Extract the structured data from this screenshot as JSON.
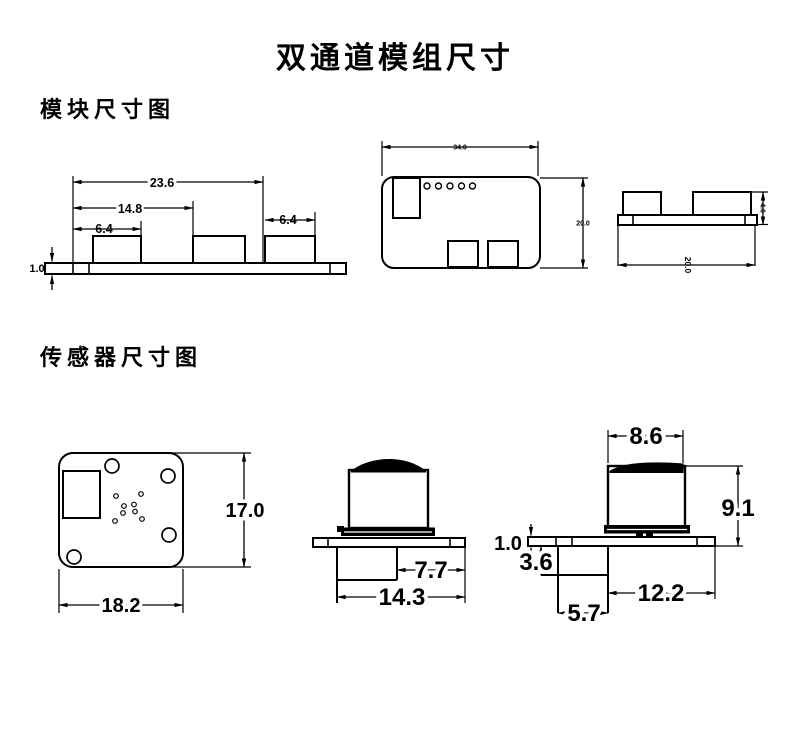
{
  "title": "双通道模组尺寸",
  "module_section": {
    "heading": "模块尺寸图",
    "side_view": {
      "overall_width": "23.6",
      "mid_width": "14.8",
      "left_box_width": "6.4",
      "right_box_width": "6.4",
      "plate_thickness": "1.0"
    },
    "top_view": {
      "board_width": "34.0",
      "board_depth": "20.0"
    },
    "end_view": {
      "box_height": "4.6",
      "board_depth": "20.0"
    }
  },
  "sensor_section": {
    "heading": "传感器尺寸图",
    "top_view": {
      "board_height": "17.0",
      "board_width": "18.2"
    },
    "front_view": {
      "inner_width": "7.7",
      "outer_width": "14.3"
    },
    "side_view": {
      "cap_width": "8.6",
      "total_height": "9.1",
      "plate_thickness": "1.0",
      "step_height": "3.6",
      "body_width": "12.2",
      "offset_width": "5.7"
    }
  }
}
